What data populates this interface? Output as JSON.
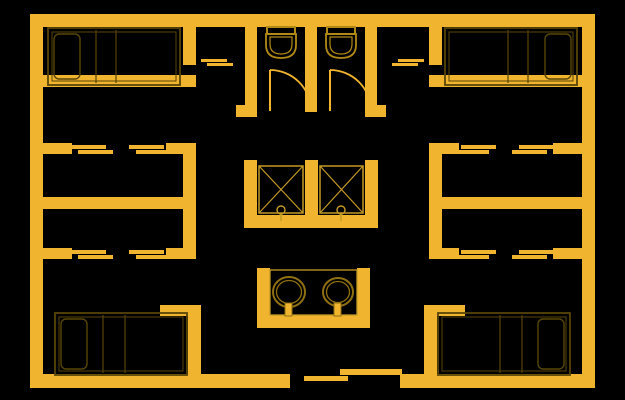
{
  "meta": {
    "description": "CAD-style architectural floor plan, yellow lines on black: four corner bedrooms with double beds, side closet rooms with sliding doors, two central toilet stalls with swing doors, two elevator shafts, double-basin sink counter, sliding main entrance at bottom center",
    "canvas": {
      "width": 625,
      "height": 400
    }
  },
  "colors": {
    "background": "#000000",
    "wall": "#F0B42E",
    "bed_line": "#574507",
    "fixture_line": "#B18A16",
    "thin_line": "#C49B25",
    "sink_line": "#8F7010"
  },
  "walls": [
    {
      "name": "outer-top",
      "x": 30,
      "y": 14,
      "w": 565,
      "h": 13
    },
    {
      "name": "outer-left",
      "x": 30,
      "y": 14,
      "w": 13,
      "h": 374
    },
    {
      "name": "outer-right",
      "x": 582,
      "y": 14,
      "w": 13,
      "h": 374
    },
    {
      "name": "outer-bottom-left",
      "x": 30,
      "y": 374,
      "w": 260,
      "h": 14
    },
    {
      "name": "outer-bottom-right",
      "x": 400,
      "y": 374,
      "w": 195,
      "h": 14
    },
    {
      "name": "vestibule-left",
      "x": 183,
      "y": 27,
      "w": 13,
      "h": 38
    },
    {
      "name": "bedroom-tl-south",
      "x": 43,
      "y": 75,
      "w": 153,
      "h": 12
    },
    {
      "name": "closet-l-top-a",
      "x": 43,
      "y": 143,
      "w": 29,
      "h": 11
    },
    {
      "name": "closet-l-top-b",
      "x": 166,
      "y": 143,
      "w": 30,
      "h": 11
    },
    {
      "name": "corridor-left",
      "x": 183,
      "y": 143,
      "w": 13,
      "h": 116
    },
    {
      "name": "closet-l-mid",
      "x": 43,
      "y": 197,
      "w": 153,
      "h": 12
    },
    {
      "name": "closet-l-bottom-a",
      "x": 43,
      "y": 248,
      "w": 29,
      "h": 11
    },
    {
      "name": "closet-l-bottom-b",
      "x": 166,
      "y": 248,
      "w": 30,
      "h": 11
    },
    {
      "name": "bedroom-bl-east",
      "x": 188,
      "y": 305,
      "w": 13,
      "h": 83
    },
    {
      "name": "bedroom-bl-north-stub",
      "x": 160,
      "y": 305,
      "w": 41,
      "h": 11
    },
    {
      "name": "vestibule-right",
      "x": 429,
      "y": 27,
      "w": 13,
      "h": 38
    },
    {
      "name": "bedroom-tr-south",
      "x": 429,
      "y": 75,
      "w": 153,
      "h": 12
    },
    {
      "name": "closet-r-top-a",
      "x": 553,
      "y": 143,
      "w": 29,
      "h": 11
    },
    {
      "name": "closet-r-top-b",
      "x": 429,
      "y": 143,
      "w": 30,
      "h": 11
    },
    {
      "name": "corridor-right",
      "x": 429,
      "y": 143,
      "w": 13,
      "h": 116
    },
    {
      "name": "closet-r-mid",
      "x": 429,
      "y": 197,
      "w": 153,
      "h": 12
    },
    {
      "name": "closet-r-bottom-a",
      "x": 553,
      "y": 248,
      "w": 29,
      "h": 11
    },
    {
      "name": "closet-r-bottom-b",
      "x": 429,
      "y": 248,
      "w": 30,
      "h": 11
    },
    {
      "name": "bedroom-br-west",
      "x": 424,
      "y": 305,
      "w": 13,
      "h": 83
    },
    {
      "name": "bedroom-br-north-stub",
      "x": 424,
      "y": 305,
      "w": 41,
      "h": 11
    },
    {
      "name": "wc-stall-left",
      "x": 245,
      "y": 27,
      "w": 12,
      "h": 90
    },
    {
      "name": "wc-stall-mid",
      "x": 305,
      "y": 27,
      "w": 12,
      "h": 85
    },
    {
      "name": "wc-stall-right",
      "x": 365,
      "y": 27,
      "w": 12,
      "h": 90
    },
    {
      "name": "wc-foot-left",
      "x": 236,
      "y": 105,
      "w": 9,
      "h": 12
    },
    {
      "name": "wc-foot-right",
      "x": 377,
      "y": 105,
      "w": 9,
      "h": 12
    },
    {
      "name": "elev-wall-left",
      "x": 244,
      "y": 160,
      "w": 13,
      "h": 68
    },
    {
      "name": "elev-wall-mid",
      "x": 305,
      "y": 160,
      "w": 13,
      "h": 68
    },
    {
      "name": "elev-wall-right",
      "x": 365,
      "y": 160,
      "w": 13,
      "h": 68
    },
    {
      "name": "elev-wall-bottom",
      "x": 244,
      "y": 215,
      "w": 134,
      "h": 13
    },
    {
      "name": "sink-wall-left",
      "x": 257,
      "y": 268,
      "w": 13,
      "h": 60
    },
    {
      "name": "sink-wall-right",
      "x": 357,
      "y": 268,
      "w": 13,
      "h": 60
    },
    {
      "name": "sink-wall-bottom",
      "x": 257,
      "y": 315,
      "w": 113,
      "h": 13
    }
  ],
  "door_panels": [
    {
      "name": "sliding-door-closet-l-top-1a",
      "x": 71,
      "y": 145,
      "w": 35,
      "h": 4
    },
    {
      "name": "sliding-door-closet-l-top-1b",
      "x": 78,
      "y": 150,
      "w": 35,
      "h": 4
    },
    {
      "name": "sliding-door-closet-l-top-2a",
      "x": 129,
      "y": 145,
      "w": 35,
      "h": 4
    },
    {
      "name": "sliding-door-closet-l-top-2b",
      "x": 136,
      "y": 150,
      "w": 35,
      "h": 4
    },
    {
      "name": "sliding-door-closet-l-bottom-1a",
      "x": 71,
      "y": 250,
      "w": 35,
      "h": 4
    },
    {
      "name": "sliding-door-closet-l-bottom-1b",
      "x": 78,
      "y": 255,
      "w": 35,
      "h": 4
    },
    {
      "name": "sliding-door-closet-l-bottom-2a",
      "x": 129,
      "y": 250,
      "w": 35,
      "h": 4
    },
    {
      "name": "sliding-door-closet-l-bottom-2b",
      "x": 136,
      "y": 255,
      "w": 35,
      "h": 4
    },
    {
      "name": "sliding-door-closet-r-top-1a",
      "x": 519,
      "y": 145,
      "w": 35,
      "h": 4
    },
    {
      "name": "sliding-door-closet-r-top-1b",
      "x": 512,
      "y": 150,
      "w": 35,
      "h": 4
    },
    {
      "name": "sliding-door-closet-r-top-2a",
      "x": 461,
      "y": 145,
      "w": 35,
      "h": 4
    },
    {
      "name": "sliding-door-closet-r-top-2b",
      "x": 454,
      "y": 150,
      "w": 35,
      "h": 4
    },
    {
      "name": "sliding-door-closet-r-bottom-1a",
      "x": 519,
      "y": 250,
      "w": 35,
      "h": 4
    },
    {
      "name": "sliding-door-closet-r-bottom-1b",
      "x": 512,
      "y": 255,
      "w": 35,
      "h": 4
    },
    {
      "name": "sliding-door-closet-r-bottom-2a",
      "x": 461,
      "y": 250,
      "w": 35,
      "h": 4
    },
    {
      "name": "sliding-door-closet-r-bottom-2b",
      "x": 454,
      "y": 255,
      "w": 35,
      "h": 4
    },
    {
      "name": "sliding-door-vestibule-l-a",
      "x": 201,
      "y": 59,
      "w": 26,
      "h": 3
    },
    {
      "name": "sliding-door-vestibule-l-b",
      "x": 207,
      "y": 63,
      "w": 26,
      "h": 3
    },
    {
      "name": "sliding-door-vestibule-r-a",
      "x": 398,
      "y": 59,
      "w": 26,
      "h": 3
    },
    {
      "name": "sliding-door-vestibule-r-b",
      "x": 392,
      "y": 63,
      "w": 26,
      "h": 3
    },
    {
      "name": "sliding-door-entrance-a",
      "x": 304,
      "y": 376,
      "w": 44,
      "h": 5
    },
    {
      "name": "sliding-door-entrance-b",
      "x": 340,
      "y": 369,
      "w": 62,
      "h": 6
    }
  ],
  "beds": [
    {
      "name": "bed-top-left",
      "rect": [
        48,
        28,
        132,
        57
      ],
      "inner": [
        52,
        32,
        124,
        49
      ],
      "pillow": [
        54,
        34,
        26,
        45
      ],
      "folds": [
        96,
        116
      ]
    },
    {
      "name": "bed-top-right",
      "rect": [
        445,
        28,
        132,
        57
      ],
      "inner": [
        449,
        32,
        124,
        49
      ],
      "pillow": [
        545,
        34,
        26,
        45
      ],
      "folds": [
        508,
        528
      ]
    },
    {
      "name": "bed-bottom-left",
      "rect": [
        55,
        313,
        132,
        62
      ],
      "inner": [
        59,
        317,
        124,
        54
      ],
      "pillow": [
        61,
        319,
        26,
        50
      ],
      "folds": [
        103,
        125
      ]
    },
    {
      "name": "bed-bottom-right",
      "rect": [
        438,
        313,
        132,
        62
      ],
      "inner": [
        442,
        317,
        124,
        54
      ],
      "pillow": [
        538,
        319,
        26,
        50
      ],
      "folds": [
        500,
        522
      ]
    }
  ],
  "toilets": [
    {
      "name": "toilet-1",
      "cx": 281,
      "top": 27
    },
    {
      "name": "toilet-2",
      "cx": 341,
      "top": 27
    }
  ],
  "stall_doors": [
    {
      "name": "wc-swing-door-1",
      "x": 270,
      "y1": 70,
      "y2": 111,
      "r": 41
    },
    {
      "name": "wc-swing-door-2",
      "x": 330,
      "y1": 70,
      "y2": 111,
      "r": 41
    }
  ],
  "elevators": {
    "shafts": [
      {
        "name": "elevator-shaft-1",
        "x": 259,
        "y": 166,
        "w": 44,
        "h": 47
      },
      {
        "name": "elevator-shaft-2",
        "x": 320,
        "y": 166,
        "w": 43,
        "h": 47
      }
    ],
    "markers": [
      {
        "name": "elevator-door-marker-1",
        "cx": 281,
        "cy": 210
      },
      {
        "name": "elevator-door-marker-2",
        "cx": 341,
        "cy": 210
      }
    ]
  },
  "sinks": {
    "counter": {
      "x": 270,
      "y": 270,
      "w": 87,
      "h": 45
    },
    "basins": [
      {
        "name": "sink-basin-1",
        "cx": 289,
        "cy": 292,
        "rx": 16,
        "ry": 15,
        "irx": 12.5,
        "iry": 11.5
      },
      {
        "name": "sink-basin-2",
        "cx": 338,
        "cy": 292,
        "rx": 15,
        "ry": 14,
        "irx": 11.5,
        "iry": 10.5
      }
    ],
    "faucets": [
      {
        "name": "sink-faucet-1",
        "x": 285,
        "y": 303,
        "w": 7,
        "h": 13
      },
      {
        "name": "sink-faucet-2",
        "x": 334,
        "y": 303,
        "w": 7,
        "h": 13
      }
    ]
  }
}
